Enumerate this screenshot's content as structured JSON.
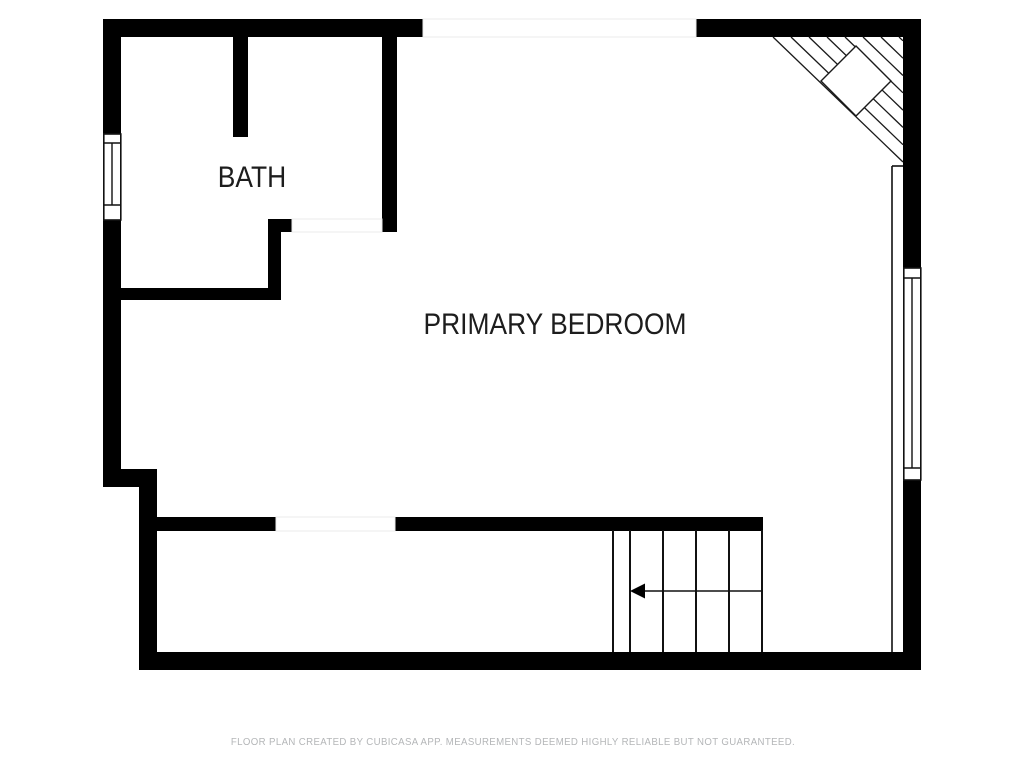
{
  "plan": {
    "labels": {
      "bath": "BATH",
      "primary_bedroom": "PRIMARY BEDROOM"
    },
    "footer": "FLOOR PLAN CREATED BY CUBICASA APP. MEASUREMENTS DEEMED HIGHLY RELIABLE BUT NOT GUARANTEED."
  },
  "colors": {
    "wall": "#000000",
    "room_label": "#1d1d1d",
    "footer_text": "#b4b6b8",
    "opening_outline": "#ebebeb",
    "background": "#ffffff"
  },
  "icons": {
    "stair_direction_arrow": "left-arrow",
    "window_symbol": "double-frame-window",
    "corner_feature": "diagonal-hatch-triangle-with-diamond"
  }
}
